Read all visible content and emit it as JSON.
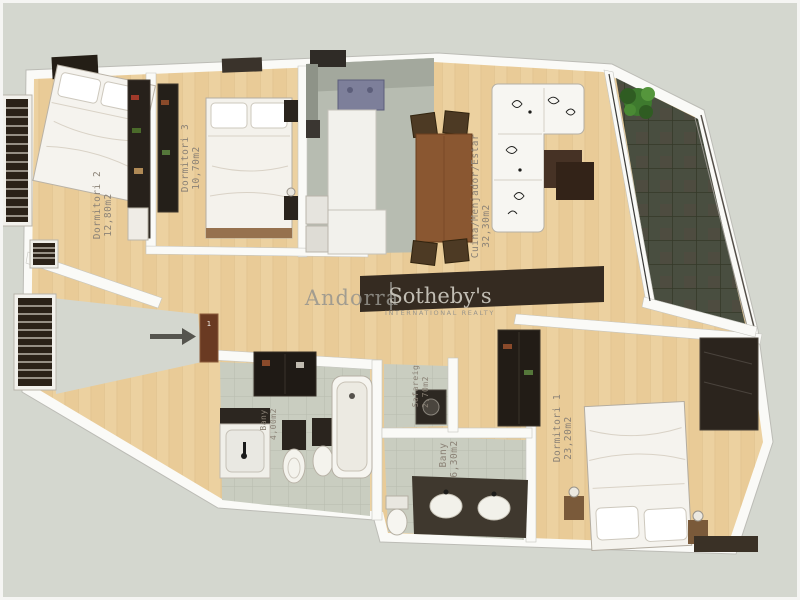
{
  "watermark": {
    "brand": "Andorra",
    "divider": "|",
    "name": "Sotheby's",
    "subtitle": "INTERNATIONAL REALTY"
  },
  "entry": {
    "door_label": "1"
  },
  "rooms": [
    {
      "id": "dormitori-2",
      "label": "Dormitori 2",
      "area": "12,80m2"
    },
    {
      "id": "dormitori-3",
      "label": "Dormitori 3",
      "area": "10,70m2"
    },
    {
      "id": "cuina-menjador-estar",
      "label": "Cuina/Menjador/Estar",
      "area": "32,30m2"
    },
    {
      "id": "dormitori-1",
      "label": "Dormitori 1",
      "area": "23,20m2"
    },
    {
      "id": "bany-gran",
      "label": "Bany",
      "area": "6,30m2"
    },
    {
      "id": "bany-petit",
      "label": "Bany",
      "area": "4,00m2"
    },
    {
      "id": "safareig",
      "label": "Safareig",
      "area": "2,70m2"
    }
  ],
  "palette": {
    "background": "#d4d7cf",
    "wall": "#fafaf7",
    "wood_floor": "#e9cb97",
    "kitchen_floor": "#b7bcb1",
    "tile_floor": "#c9cdc0",
    "balcony_floor": "#494e40",
    "label_text": "#8b8276",
    "watermark_text": "#96948e"
  }
}
